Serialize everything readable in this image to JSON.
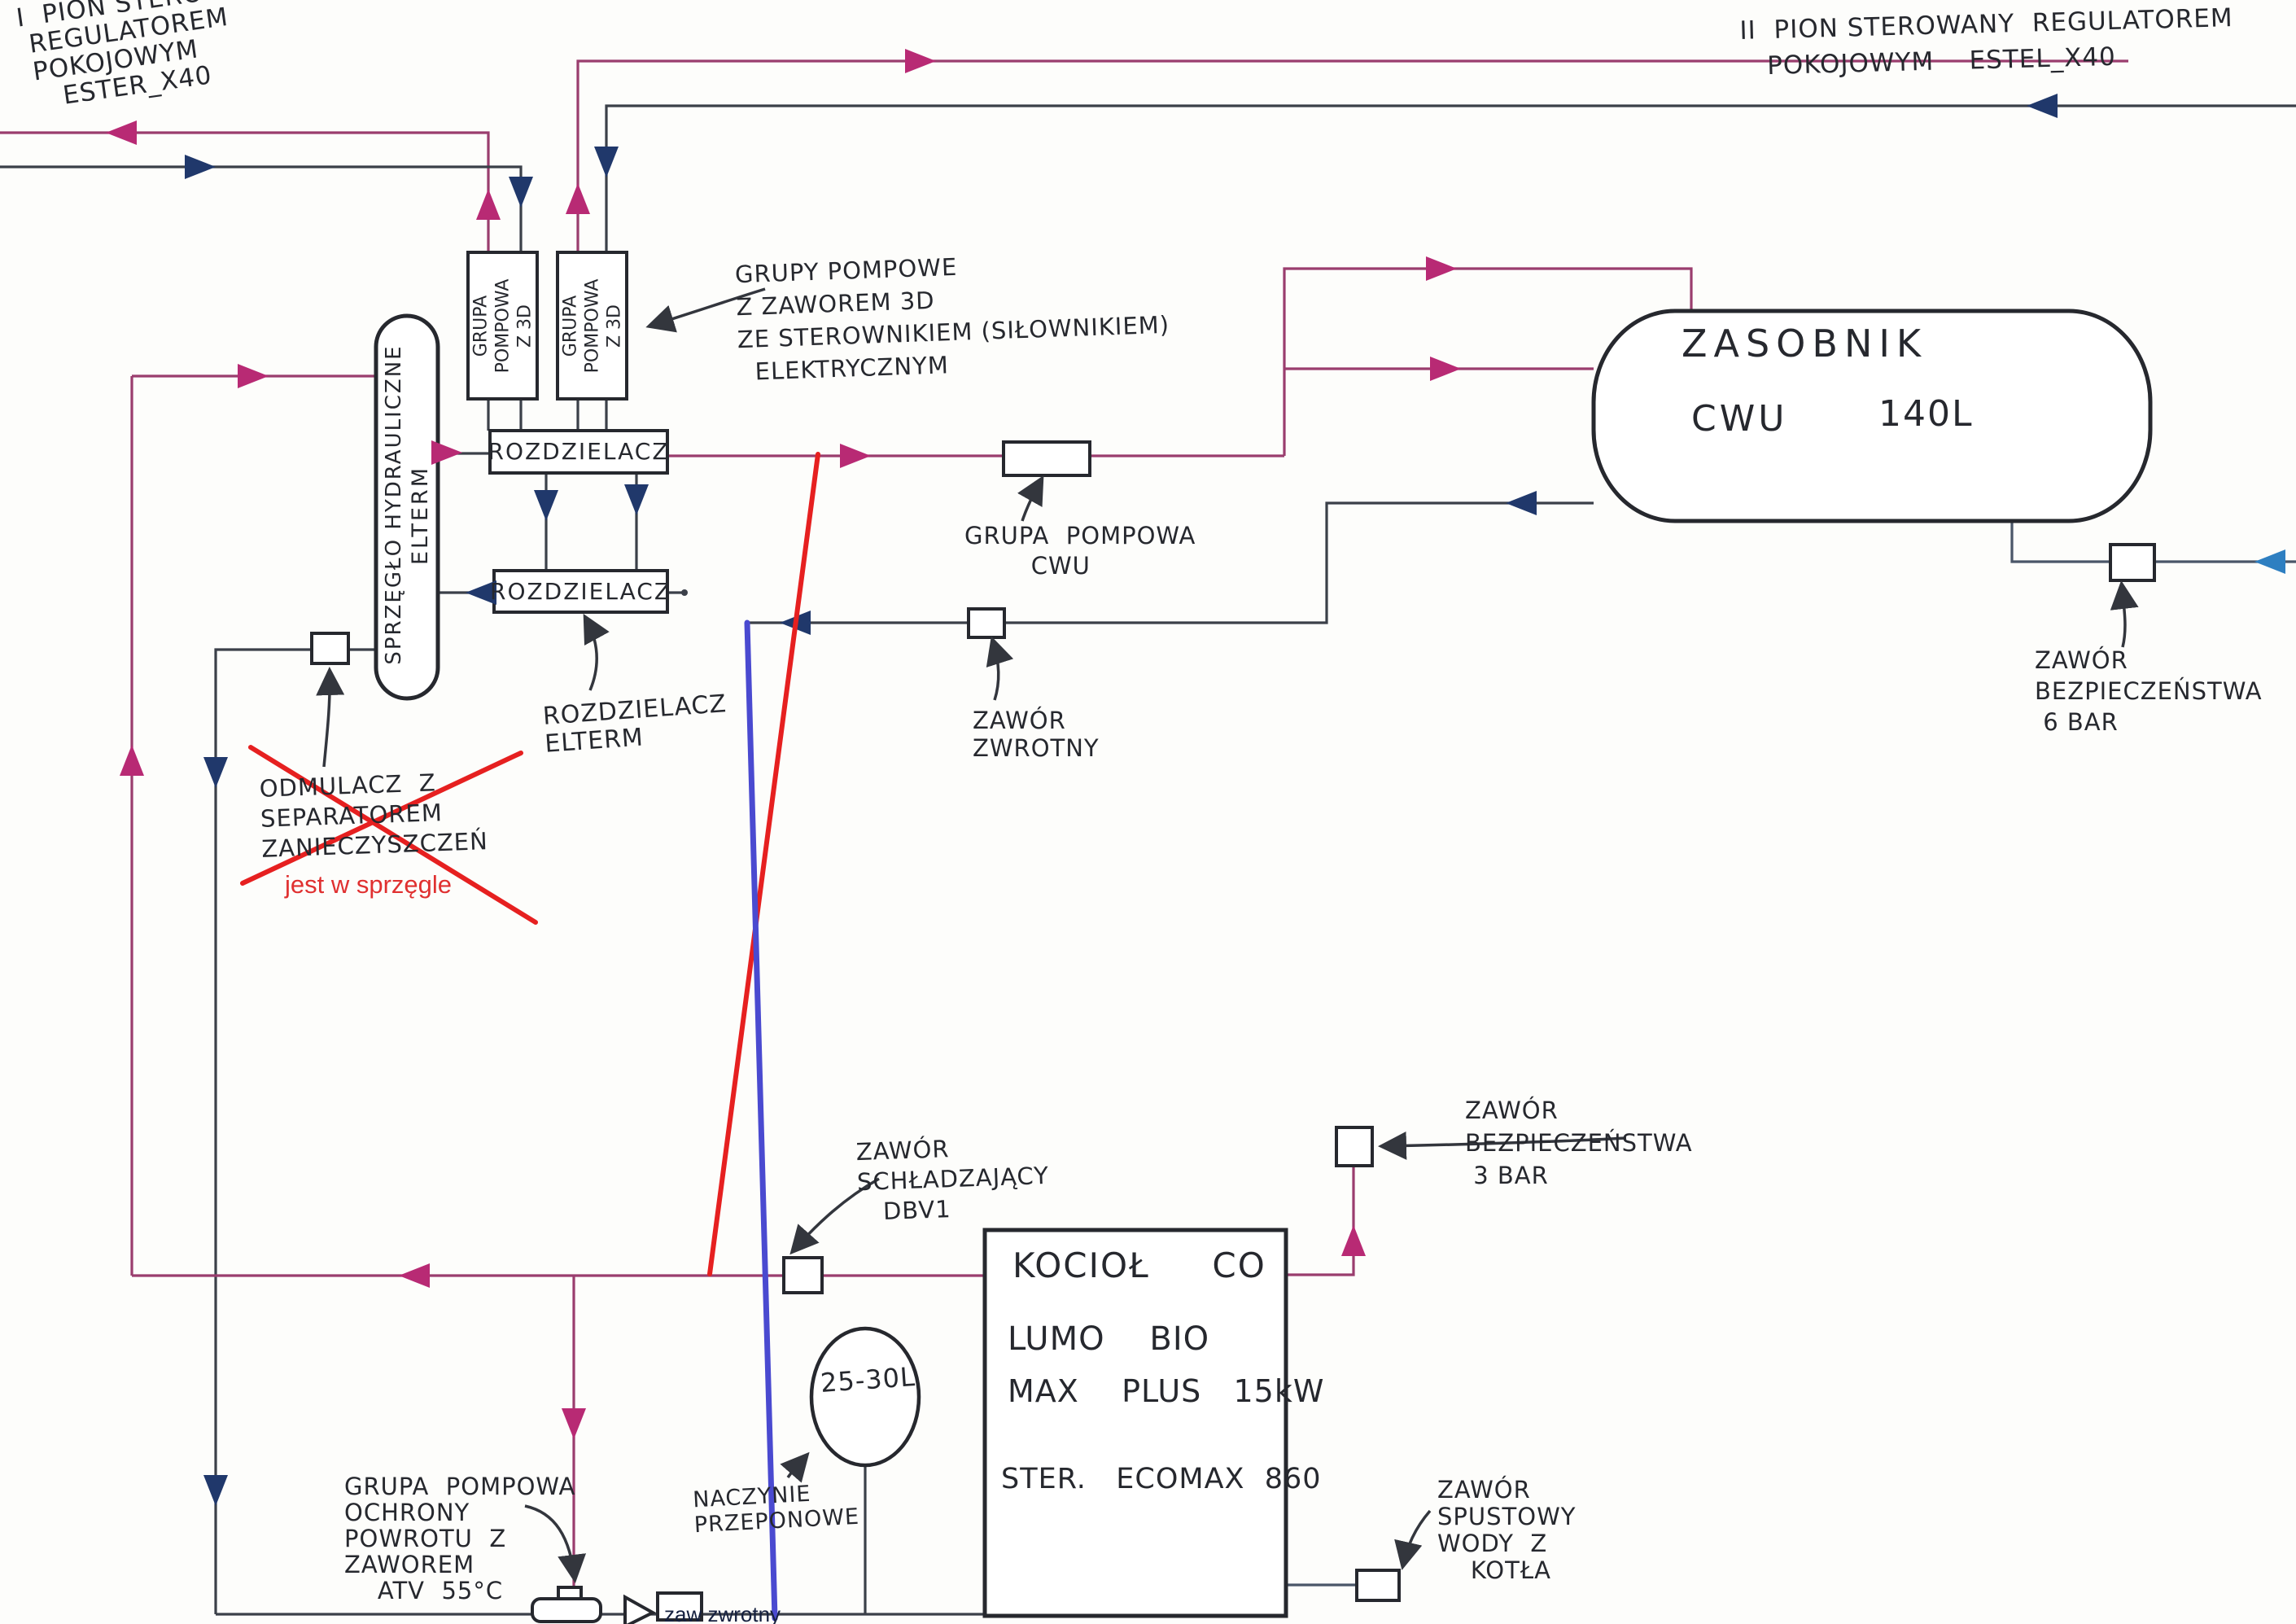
{
  "colors": {
    "supply": "#9a3d6e",
    "arrow_supply": "#b82a74",
    "ret": "#3b4049",
    "arrow_return": "#20386b",
    "correction_red": "#e62020",
    "correction_blue": "#4a4ad0",
    "cold_blue": "#2e7fc1",
    "ink": "#26282e",
    "typed_red": "#e03030",
    "typed_navy": "#15203f",
    "paper": "#fdfdfb"
  },
  "labels": {
    "pion1": "I  PION STEROWANY\n REGULATOREM\n POKOJOWYM\n    ESTER_X40",
    "pion2": "II  PION STEROWANY  REGULATOREM\n   POKOJOWYM    ESTEL_X40",
    "grupy_note": "GRUPY POMPOWE\nZ ZAWOREM 3D\nZE STEROWNIKIEM (SIŁOWNIKIEM)\n  ELEKTRYCZNYM",
    "pump_group": "GRUPA\nPOMPOWA\nZ 3D",
    "rozdzielacz": "ROZDZIELACZ",
    "rozdzielacz_note": "ROZDZIELACZ\nELTERM",
    "sprzeglo": "SPRZĘGŁO HYDRAULICZNE",
    "elterm": "ELTERM",
    "odmulacz": "ODMULACZ  Z\nSEPARATOREM\nZANIECZYSZCZEŃ",
    "jest_w_sprzegle": "jest w sprzęgle",
    "zasobnik": "ZASOBNIK",
    "zasobnik_cwu": "CWU",
    "zasobnik_vol": "140L",
    "grupa_cwu": "GRUPA  POMPOWA\n        CWU",
    "zawor_zwrotny_cwu": "ZAWÓR\nZWROTNY",
    "zawor_bezp_6bar": "ZAWÓR\nBEZPIECZEŃSTWA\n 6 BAR",
    "zawor_bezp_3bar": "ZAWÓR\nBEZPIECZEŃSTWA\n 3 BAR",
    "zawor_schladzajacy": "ZAWÓR\nSCHŁADZAJĄCY\n   DBV1",
    "kociol_line1": "KOCIOŁ     CO",
    "kociol_line2": "LUMO    BIO",
    "kociol_line3": "MAX    PLUS   15kW",
    "kociol_line4": "STER.   ECOMAX  860",
    "naczynie": "NACZYNIE\nPRZEPONOWE",
    "naczynie_vol": "25-30L",
    "grupa_atv": "GRUPA  POMPOWA\nOCHRONY\nPOWROTU  Z\nZAWOREM\n    ATV  55°C",
    "zaw_zwrotny_typed": "zaw zwrotny",
    "zawor_spustowy": "ZAWÓR\nSPUSTOWY\nWODY  Z\n    KOTŁA"
  }
}
